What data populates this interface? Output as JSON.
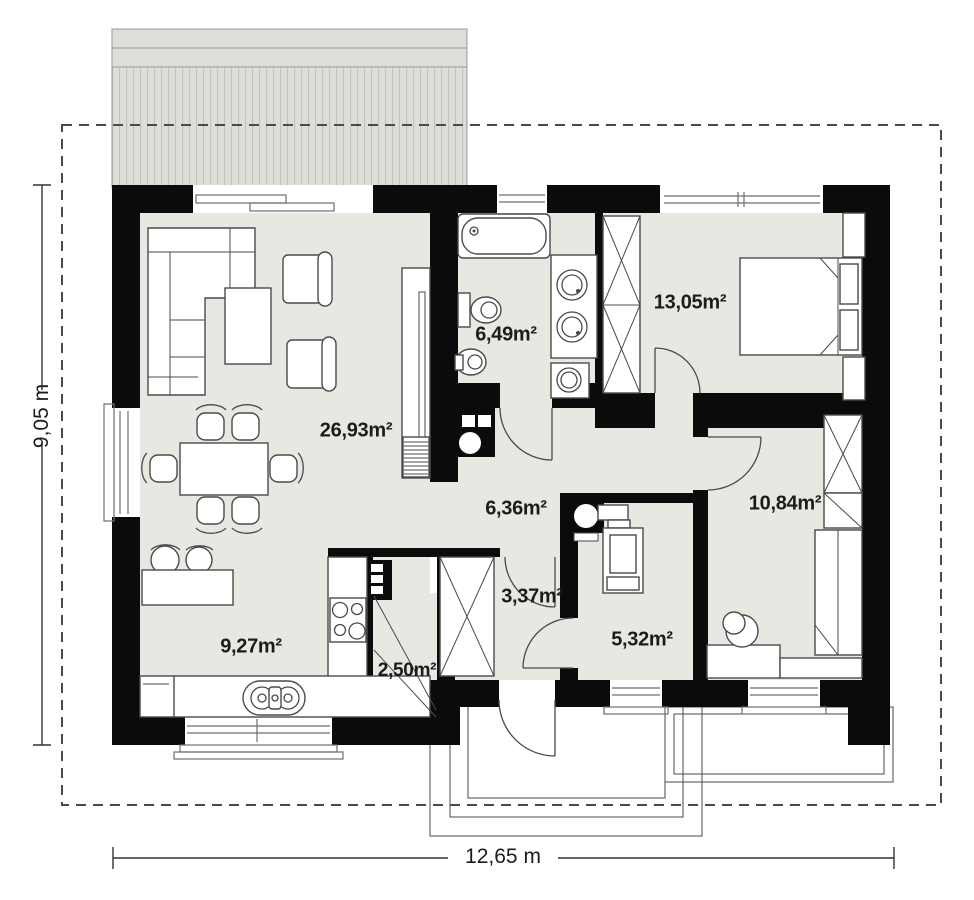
{
  "plan_title": "Single-storey house floor plan",
  "rooms": [
    {
      "name": "living-dining-room",
      "area": "26,93m²"
    },
    {
      "name": "bathroom",
      "area": "6,49m²"
    },
    {
      "name": "bedroom",
      "area": "13,05m²"
    },
    {
      "name": "hallway",
      "area": "6,36m²"
    },
    {
      "name": "corridor",
      "area": "3,37m²"
    },
    {
      "name": "utility-room",
      "area": "5,32m²"
    },
    {
      "name": "bedroom-2",
      "area": "10,84m²"
    },
    {
      "name": "kitchen",
      "area": "9,27m²"
    },
    {
      "name": "pantry",
      "area": "2,50m²"
    }
  ],
  "dimensions": {
    "width": "12,65 m",
    "height": "9,05 m"
  },
  "colors": {
    "wall": "#0b0b0b",
    "floor": "#e8e8e2",
    "terrace": "#deded9",
    "stripe": "#c3c3be",
    "outline": "#4a4a4a",
    "text": "#1c1c1c",
    "boundary": "#4a4a4a"
  }
}
